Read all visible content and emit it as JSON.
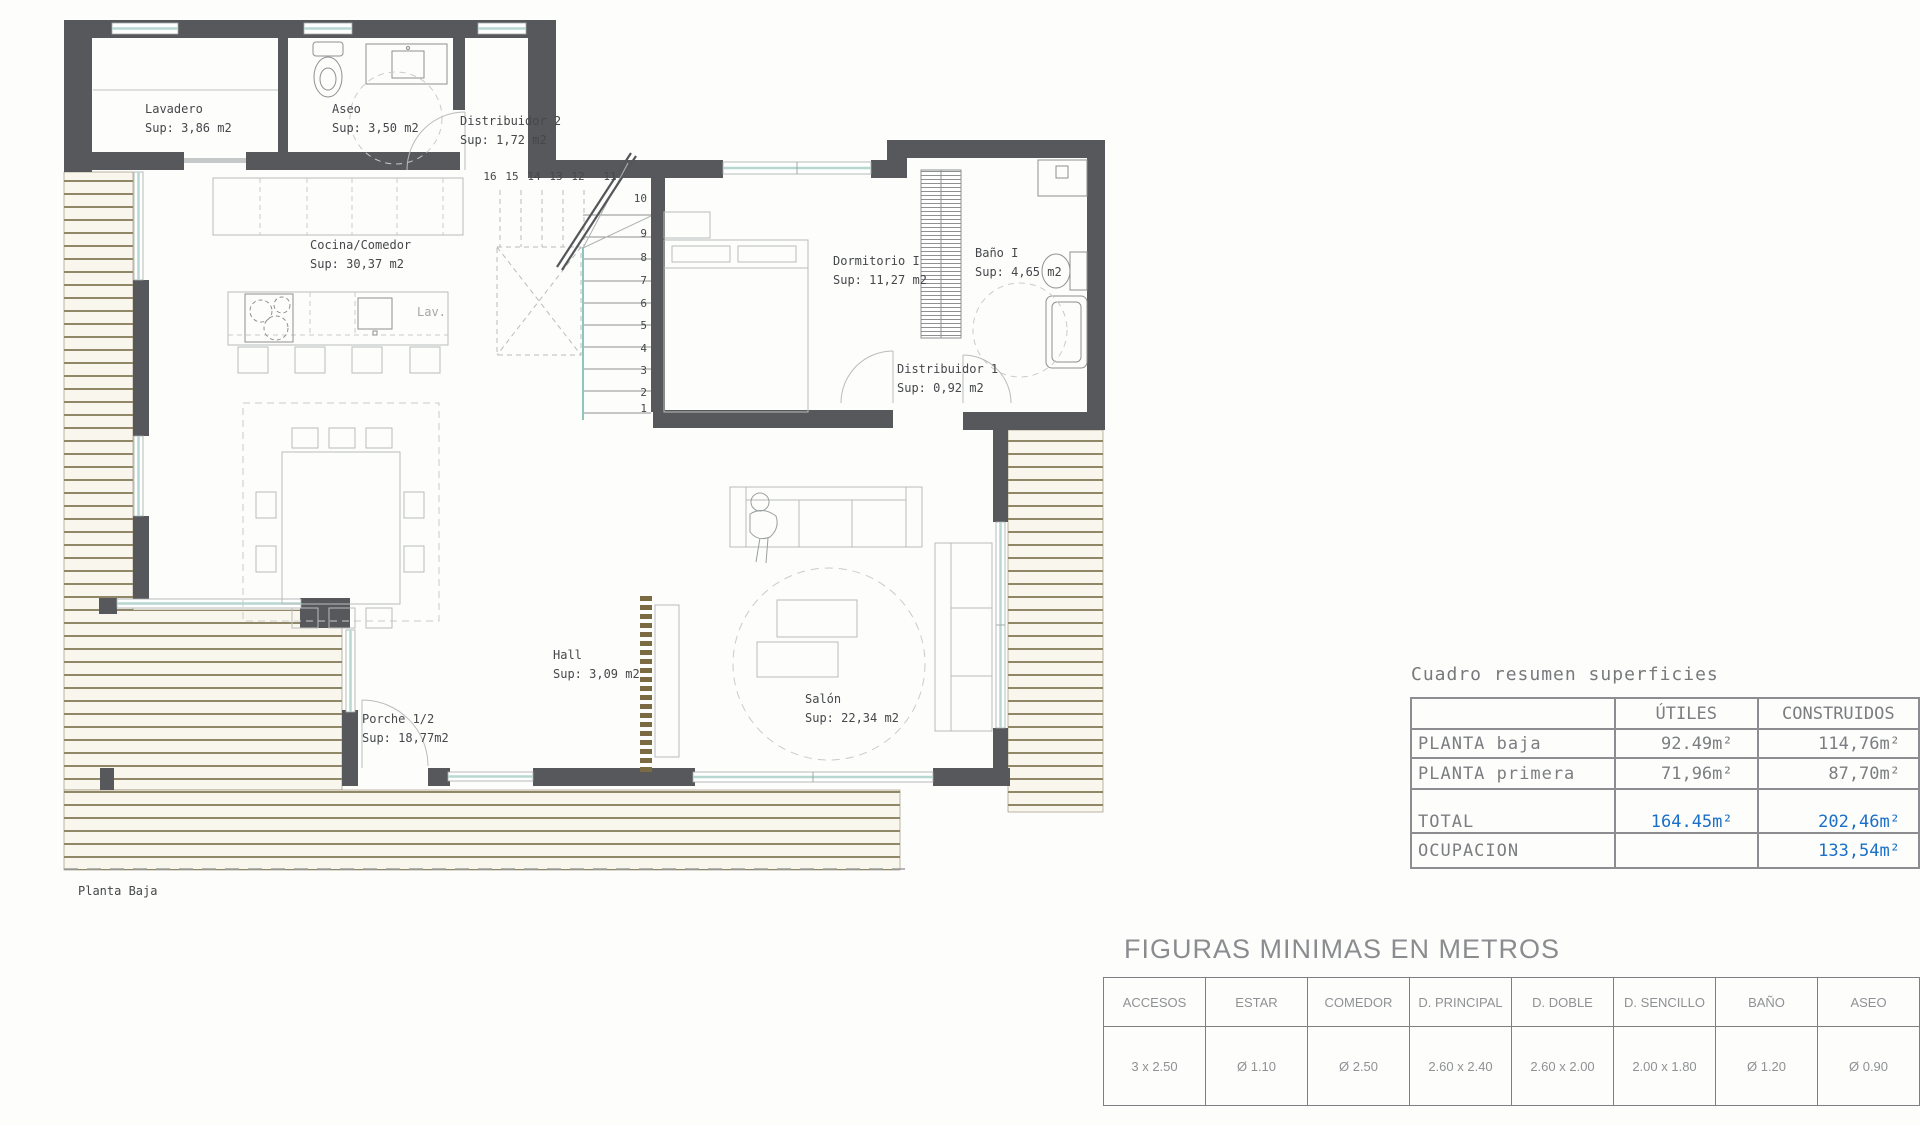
{
  "plan": {
    "sheet_title": "Planta Baja",
    "rooms": [
      {
        "name": "Lavadero",
        "sup": "Sup: 3,86 m2"
      },
      {
        "name": "Aseo",
        "sup": "Sup: 3,50 m2"
      },
      {
        "name": "Distribuidor 2",
        "sup": "Sup: 1,72 m2"
      },
      {
        "name": "Cocina/Comedor",
        "sup": "Sup: 30,37 m2"
      },
      {
        "name": "Dormitorio I",
        "sup": "Sup: 11,27 m2"
      },
      {
        "name": "Baño I",
        "sup": "Sup: 4,65 m2"
      },
      {
        "name": "Distribuidor 1",
        "sup": "Sup: 0,92 m2"
      },
      {
        "name": "Hall",
        "sup": "Sup: 3,09 m2"
      },
      {
        "name": "Salón",
        "sup": "Sup: 22,34 m2"
      },
      {
        "name": "Porche 1/2",
        "sup": "Sup: 18,77m2"
      }
    ],
    "kitchen_sink_label": "Lav.",
    "stairs_upper": [
      "16",
      "15",
      "14",
      "13",
      "12",
      "11"
    ],
    "stairs_lower": [
      "10",
      "9",
      "8",
      "7",
      "6",
      "5",
      "4",
      "3",
      "2",
      "1"
    ]
  },
  "summary_table": {
    "title": "Cuadro resumen superficies",
    "columns": [
      "",
      "ÚTILES",
      "CONSTRUIDOS"
    ],
    "rows": [
      {
        "label": "PLANTA  baja",
        "utiles": "92.49m²",
        "construidos": "114,76m²"
      },
      {
        "label": "PLANTA  primera",
        "utiles": "71,96m²",
        "construidos": "87,70m²"
      },
      {
        "label": "TOTAL",
        "utiles": "164.45m²",
        "construidos": "202,46m²"
      },
      {
        "label": "OCUPACION",
        "utiles": "",
        "construidos": "133,54m²"
      }
    ]
  },
  "figuras_table": {
    "title": "FIGURAS MINIMAS EN METROS",
    "columns": [
      "ACCESOS",
      "ESTAR",
      "COMEDOR",
      "D. PRINCIPAL",
      "D. DOBLE",
      "D. SENCILLO",
      "BAÑO",
      "ASEO"
    ],
    "values": [
      "3 x 2.50",
      "Ø 1.10",
      "Ø 2.50",
      "2.60 x 2.40",
      "2.60 x 2.00",
      "2.00 x 1.80",
      "Ø 1.20",
      "Ø 0.90"
    ]
  },
  "colors": {
    "wall": "#57585b",
    "window_glazing": "#b7d8d0",
    "deck_line": "#8f8768",
    "deck_fill": "#f9f6ee",
    "accent_blue": "#1a6fc7",
    "table_gray": "#7b7d80",
    "wood_strip": "#7b6b43"
  }
}
